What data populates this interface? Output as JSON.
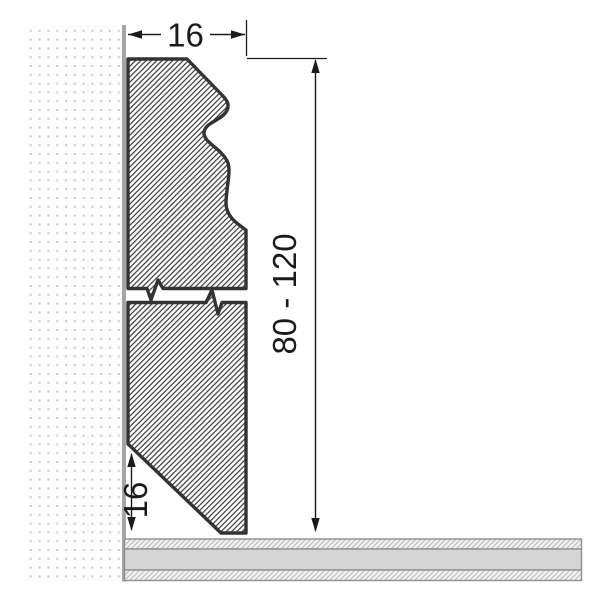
{
  "drawing": {
    "kind": "skirting-board-cross-section",
    "labels": {
      "width_top": "16",
      "height_range": "80 - 120",
      "bevel_height": "16"
    }
  },
  "colors": {
    "outline": "#333333",
    "hatch-line": "#3a3a3a",
    "hatch-bg": "#ffffff",
    "wall-dot": "#cdcdcd",
    "wall-bg": "#fdfdfd",
    "wall-edge": "#a5a5a5",
    "floor-line": "#8f8f8f",
    "floor-fill": "#d4d4d4",
    "floor-hatch-line": "#b7b7b7",
    "floor-hatch-bg": "#efefef",
    "dimension": "#1b1b1b"
  }
}
